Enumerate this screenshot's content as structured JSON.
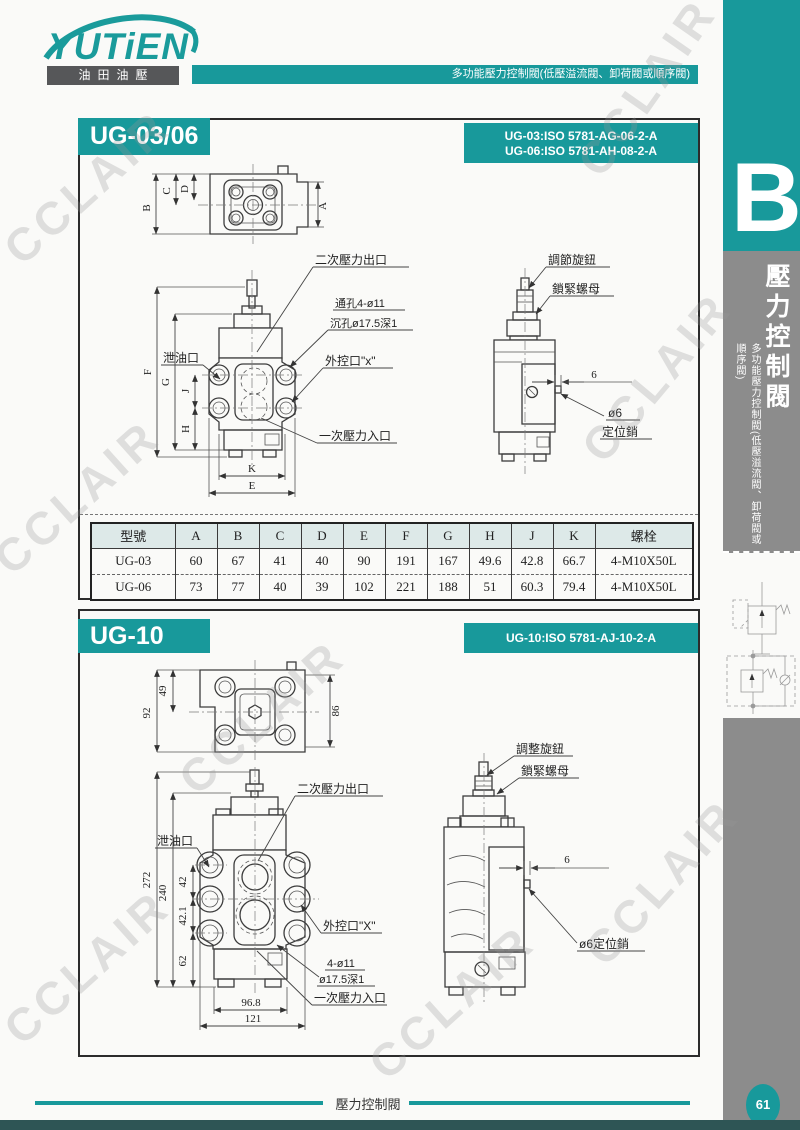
{
  "header": {
    "logo_text": "YUTiEN",
    "logo_sub": "油田油壓",
    "banner": "多功能壓力控制閥(低壓溢流閥、卸荷閥或順序閥)"
  },
  "sidebar": {
    "tab_letter": "B",
    "title_vertical": "壓力控制閥",
    "subtitle_vertical": "多功能壓力控制閥(低壓溢流閥、卸荷閥或順序閥)",
    "page_number": "61"
  },
  "footer": {
    "title": "壓力控制閥"
  },
  "watermark": "CCLAIR",
  "colors": {
    "teal": "#18999b",
    "sidebar_gray": "#8c8c8c",
    "logo_box": "#565759",
    "table_header_bg": "#dde9e8"
  },
  "section1": {
    "title": "UG-03/06",
    "iso_line1": "UG-03:ISO 5781-AG-06-2-A",
    "iso_line2": "UG-06:ISO 5781-AH-08-2-A",
    "top_dims": {
      "a": "A",
      "b": "B",
      "c": "C",
      "d": "D"
    },
    "front": {
      "labels": {
        "outlet": "二次壓力出口",
        "through_hole": "通孔4-ø11",
        "counterbore": "沉孔ø17.5深1",
        "pilot": "外控口\"x\"",
        "drain": "泄油口",
        "inlet": "一次壓力入口"
      },
      "dims": {
        "f": "F",
        "g": "G",
        "j": "J",
        "h": "H",
        "k": "K",
        "e": "E"
      }
    },
    "side": {
      "knob": "調節旋鈕",
      "locknut": "鎖緊螺母",
      "gap": "6",
      "pin_dia": "ø6",
      "pin_name": "定位銷"
    },
    "table": {
      "headers": [
        "型號",
        "A",
        "B",
        "C",
        "D",
        "E",
        "F",
        "G",
        "H",
        "J",
        "K",
        "螺栓"
      ],
      "rows": [
        [
          "UG-03",
          "60",
          "67",
          "41",
          "40",
          "90",
          "191",
          "167",
          "49.6",
          "42.8",
          "66.7",
          "4-M10X50L"
        ],
        [
          "UG-06",
          "73",
          "77",
          "40",
          "39",
          "102",
          "221",
          "188",
          "51",
          "60.3",
          "79.4",
          "4-M10X50L"
        ]
      ]
    }
  },
  "section2": {
    "title": "UG-10",
    "iso_line": "UG-10:ISO 5781-AJ-10-2-A",
    "top_dims": {
      "h49": "49",
      "h92": "92",
      "h86": "86"
    },
    "front": {
      "labels": {
        "outlet": "二次壓力出口",
        "drain": "泄油口",
        "pilot": "外控口\"X\"",
        "holes": "4-ø11",
        "counterbore": "ø17.5深1",
        "inlet": "一次壓力入口"
      },
      "dims": {
        "d272": "272",
        "d240": "240",
        "d42": "42",
        "d421": "42.1",
        "d62": "62",
        "w968": "96.8",
        "w121": "121"
      }
    },
    "side": {
      "knob": "調整旋鈕",
      "locknut": "鎖緊螺母",
      "gap": "6",
      "pin": "ø6定位銷"
    }
  }
}
